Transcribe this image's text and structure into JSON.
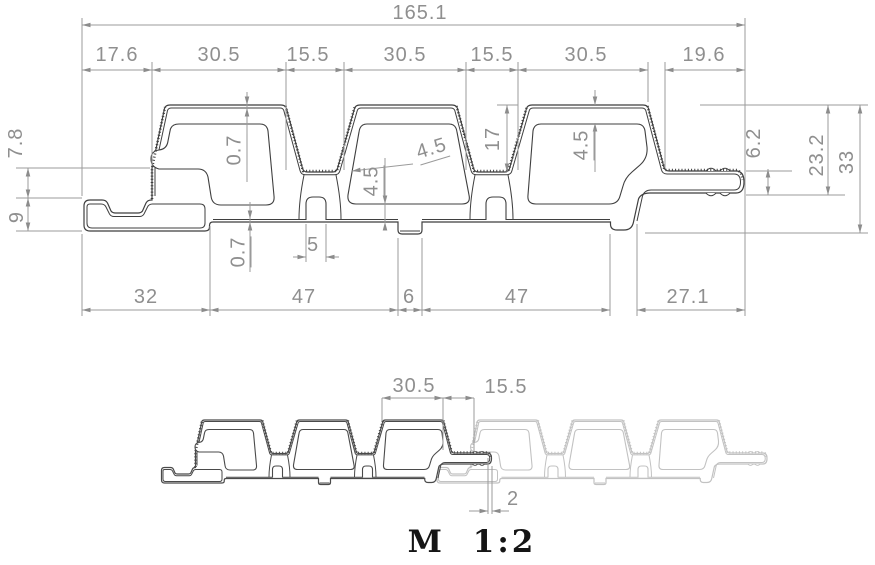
{
  "drawing": {
    "type": "profile-cross-section",
    "units": "mm",
    "overall_width": "165.1",
    "overall_height": "33",
    "top_chain": [
      "17.6",
      "30.5",
      "15.5",
      "30.5",
      "15.5",
      "30.5",
      "19.6"
    ],
    "bottom_chain": [
      "32",
      "47",
      "6",
      "47",
      "27.1"
    ],
    "left_dims": [
      "7.8",
      "9"
    ],
    "right_dims": [
      "6.2",
      "23.2",
      "33"
    ],
    "detail_dims": [
      "0.7",
      "0.7",
      "4.5",
      "4.5",
      "17",
      "4.5",
      "5"
    ]
  },
  "scale_view": {
    "caption": "M 1:2",
    "dims": [
      "30.5",
      "15.5",
      "2"
    ]
  },
  "colors": {
    "background": "#ffffff",
    "profile_outline": "#3f3f3f",
    "profile_light": "#c2c2c2",
    "dimension_line": "#9b9b9b",
    "dimension_text": "#8f8f8f",
    "caption_text": "#151515"
  },
  "labels": [
    {
      "text": "165.1",
      "x": 420,
      "y": 13,
      "rot": 0,
      "ul": false
    },
    {
      "text": "17.6",
      "x": 117,
      "y": 55,
      "rot": 0,
      "ul": false
    },
    {
      "text": "30.5",
      "x": 219,
      "y": 55,
      "rot": 0,
      "ul": false
    },
    {
      "text": "15.5",
      "x": 308,
      "y": 55,
      "rot": 0,
      "ul": false
    },
    {
      "text": "30.5",
      "x": 405,
      "y": 55,
      "rot": 0,
      "ul": false
    },
    {
      "text": "15.5",
      "x": 492,
      "y": 55,
      "rot": 0,
      "ul": false
    },
    {
      "text": "30.5",
      "x": 586,
      "y": 55,
      "rot": 0,
      "ul": false
    },
    {
      "text": "19.6",
      "x": 704,
      "y": 55,
      "rot": 0,
      "ul": false
    },
    {
      "text": "7.8",
      "x": 16,
      "y": 143,
      "rot": -90,
      "ul": false
    },
    {
      "text": "9",
      "x": 17,
      "y": 217,
      "rot": -90,
      "ul": false
    },
    {
      "text": "0.7",
      "x": 236,
      "y": 150,
      "rot": -90,
      "ul": true
    },
    {
      "text": "0.7",
      "x": 240,
      "y": 252,
      "rot": -90,
      "ul": true
    },
    {
      "text": "4.5",
      "x": 373,
      "y": 181,
      "rot": -90,
      "ul": true
    },
    {
      "text": "4.5",
      "x": 432,
      "y": 150,
      "rot": -17,
      "ul": true
    },
    {
      "text": "17",
      "x": 493,
      "y": 139,
      "rot": -90,
      "ul": false
    },
    {
      "text": "4.5",
      "x": 583,
      "y": 145,
      "rot": -90,
      "ul": true
    },
    {
      "text": "5",
      "x": 313,
      "y": 245,
      "rot": 0,
      "ul": false
    },
    {
      "text": "6.2",
      "x": 754,
      "y": 143,
      "rot": -90,
      "ul": false
    },
    {
      "text": "23.2",
      "x": 817,
      "y": 155,
      "rot": -90,
      "ul": false
    },
    {
      "text": "33",
      "x": 847,
      "y": 162,
      "rot": -90,
      "ul": false
    },
    {
      "text": "32",
      "x": 146,
      "y": 297,
      "rot": 0,
      "ul": false
    },
    {
      "text": "47",
      "x": 304,
      "y": 297,
      "rot": 0,
      "ul": false
    },
    {
      "text": "6",
      "x": 409,
      "y": 297,
      "rot": 0,
      "ul": false
    },
    {
      "text": "47",
      "x": 517,
      "y": 297,
      "rot": 0,
      "ul": false
    },
    {
      "text": "27.1",
      "x": 688,
      "y": 297,
      "rot": 0,
      "ul": false
    },
    {
      "text": "30.5",
      "x": 414,
      "y": 386,
      "rot": 0,
      "ul": false
    },
    {
      "text": "15.5",
      "x": 506,
      "y": 387,
      "rot": 0,
      "ul": false
    },
    {
      "text": "2",
      "x": 513,
      "y": 499,
      "rot": 0,
      "ul": false
    }
  ]
}
